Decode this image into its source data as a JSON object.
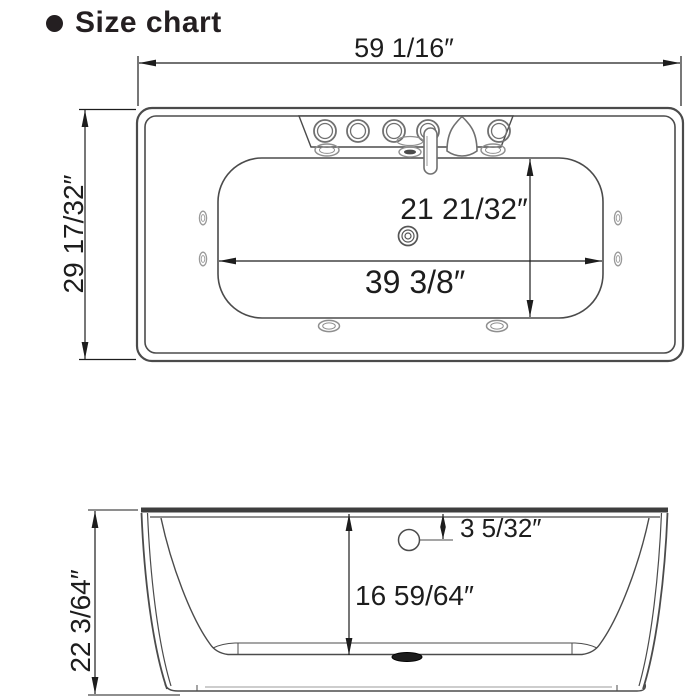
{
  "header": {
    "title": "Size chart"
  },
  "colors": {
    "line": "#4b4b4b",
    "dim": "#1d1d1d",
    "fixture": "#757575",
    "jet": "#8f8f8f",
    "background": "#ffffff"
  },
  "top_view": {
    "name": "bathtub top view",
    "overall_length": "59 1/16″",
    "overall_width": "29 17/32″",
    "basin_width": "21 21/32″",
    "basin_length": "39 3/8″"
  },
  "side_view": {
    "name": "bathtub side view",
    "overall_height": "22 3/64″",
    "inner_depth": "16 59/64″",
    "overflow_offset": "3 5/32″"
  }
}
